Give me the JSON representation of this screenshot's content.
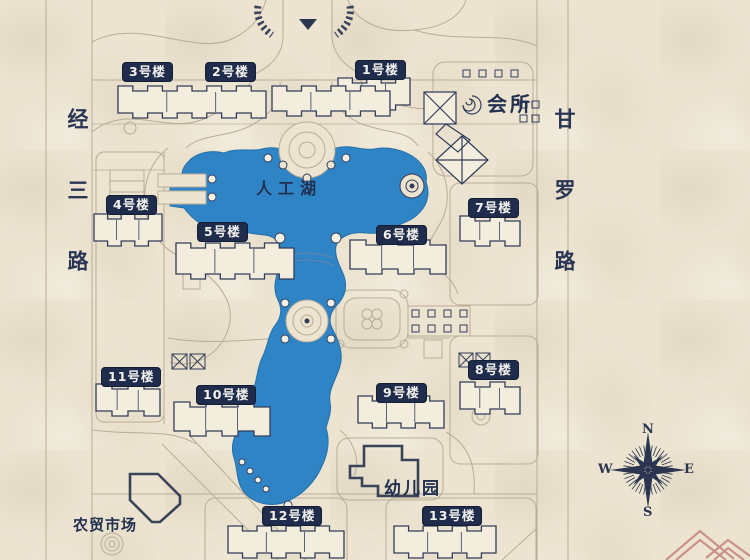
{
  "map": {
    "roads": {
      "left": "经三路",
      "right": "甘罗路"
    },
    "lake": {
      "label": "人工湖"
    },
    "facilities": {
      "clubhouse": "会所",
      "kindergarten": "幼儿园",
      "market": "农贸市场"
    },
    "buildings": [
      {
        "id": 1,
        "label": "1号楼"
      },
      {
        "id": 2,
        "label": "2号楼"
      },
      {
        "id": 3,
        "label": "3号楼"
      },
      {
        "id": 4,
        "label": "4号楼"
      },
      {
        "id": 5,
        "label": "5号楼"
      },
      {
        "id": 6,
        "label": "6号楼"
      },
      {
        "id": 7,
        "label": "7号楼"
      },
      {
        "id": 8,
        "label": "8号楼"
      },
      {
        "id": 9,
        "label": "9号楼"
      },
      {
        "id": 10,
        "label": "10号楼"
      },
      {
        "id": 11,
        "label": "11号楼"
      },
      {
        "id": 12,
        "label": "12号楼"
      },
      {
        "id": 13,
        "label": "13号楼"
      }
    ],
    "compass": {
      "north": "N",
      "east": "E",
      "south": "S",
      "west": "W"
    },
    "colors": {
      "background": "#ECE4D1",
      "lake": "#2F84C6",
      "badge": "#202C4C",
      "building_line": "#333D59",
      "path_line": "#B8AC96",
      "text": "#22304F",
      "watermark": "#C5837F"
    }
  }
}
